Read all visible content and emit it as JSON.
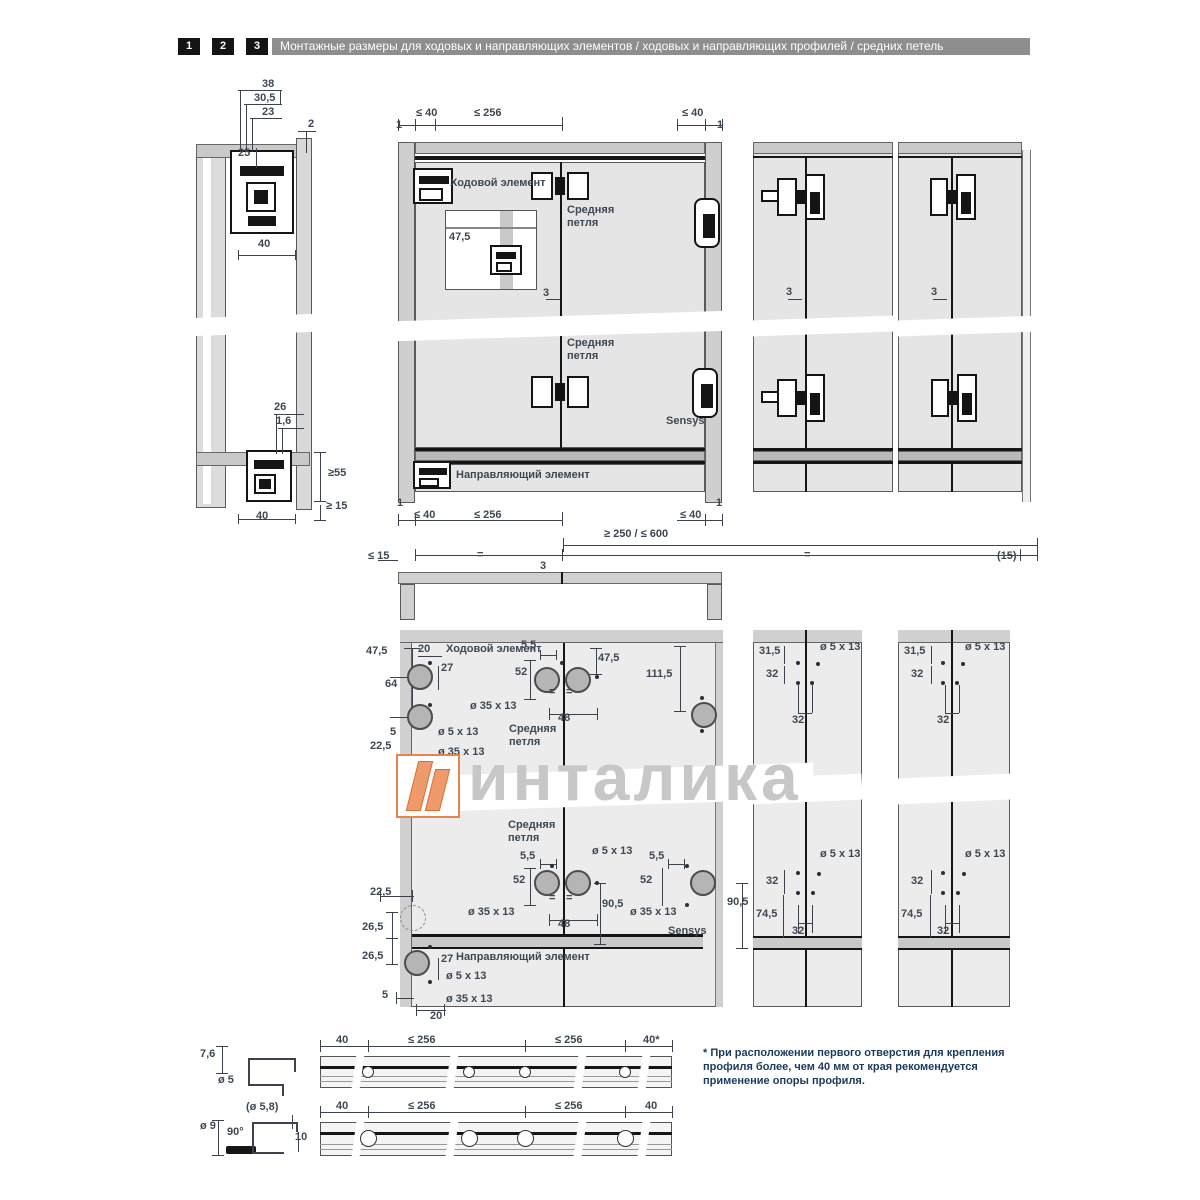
{
  "header": {
    "tabs": [
      "1",
      "2",
      "3"
    ],
    "title": "Монтажные размеры для ходовых и направляющих элементов / ходовых и направляющих профилей / средних петель"
  },
  "watermark": {
    "text": "инталика",
    "logo": "intalika-logo",
    "logo_color": "#E8834F",
    "text_color": "#C7C7C7"
  },
  "footnote": "* При расположении первого отверстия для крепления\nпрофиля более, чем 40 мм от края рекомендуется\nприменение опоры профиля.",
  "colors": {
    "header_bar": "#8E8E8E",
    "tab_bg": "#141414",
    "dim_text": "#3D4854",
    "footnote_text": "#1C3A5E",
    "panel_fill": "#E7E7E7",
    "rail_fill": "#C9C9C9"
  },
  "holes": [
    {
      "x": 420,
      "y": 677,
      "d": 26
    },
    {
      "x": 420,
      "y": 717,
      "d": 26
    },
    {
      "x": 547,
      "y": 680,
      "d": 26
    },
    {
      "x": 578,
      "y": 680,
      "d": 26
    },
    {
      "x": 704,
      "y": 715,
      "d": 26
    },
    {
      "x": 547,
      "y": 883,
      "d": 26
    },
    {
      "x": 578,
      "y": 883,
      "d": 26
    },
    {
      "x": 703,
      "y": 883,
      "d": 26
    },
    {
      "x": 417,
      "y": 963,
      "d": 26
    },
    {
      "x": 413,
      "y": 918,
      "d": 26,
      "dashed": true
    },
    {
      "x": 368,
      "y": 1072,
      "d": 12,
      "rail": true
    },
    {
      "x": 469,
      "y": 1072,
      "d": 12,
      "rail": true
    },
    {
      "x": 525,
      "y": 1072,
      "d": 12,
      "rail": true
    },
    {
      "x": 625,
      "y": 1072,
      "d": 12,
      "rail": true
    },
    {
      "x": 368,
      "y": 1138,
      "d": 17,
      "rail": true
    },
    {
      "x": 469,
      "y": 1138,
      "d": 17,
      "rail": true
    },
    {
      "x": 525,
      "y": 1138,
      "d": 17,
      "rail": true
    },
    {
      "x": 625,
      "y": 1138,
      "d": 17,
      "rail": true
    }
  ],
  "annotations": [
    {
      "name": "dim-38",
      "text": "38",
      "x": 262,
      "y": 78
    },
    {
      "name": "dim-30_5",
      "text": "30,5",
      "x": 254,
      "y": 92
    },
    {
      "name": "dim-23",
      "text": "23",
      "x": 262,
      "y": 106
    },
    {
      "name": "dim-2",
      "text": "2",
      "x": 308,
      "y": 118
    },
    {
      "name": "dim-25",
      "text": "25",
      "x": 238,
      "y": 147
    },
    {
      "name": "dim-40-top",
      "text": "40",
      "x": 258,
      "y": 238
    },
    {
      "name": "dim-26",
      "text": "26",
      "x": 274,
      "y": 401
    },
    {
      "name": "dim-1_6",
      "text": "1,6",
      "x": 276,
      "y": 415
    },
    {
      "name": "dim-ge55",
      "text": "≥55",
      "x": 328,
      "y": 467
    },
    {
      "name": "dim-ge15",
      "text": "≥ 15",
      "x": 326,
      "y": 500
    },
    {
      "name": "dim-40-bottom",
      "text": "40",
      "x": 256,
      "y": 510
    },
    {
      "name": "dim-le40-top-left",
      "text": "≤ 40",
      "x": 416,
      "y": 107
    },
    {
      "name": "dim-le256-top",
      "text": "≤ 256",
      "x": 474,
      "y": 107
    },
    {
      "name": "dim-le40-top-right",
      "text": "≤ 40",
      "x": 682,
      "y": 107
    },
    {
      "name": "dim-1-top-left",
      "text": "1",
      "x": 396,
      "y": 119
    },
    {
      "name": "dim-1-top-right",
      "text": "1",
      "x": 717,
      "y": 119
    },
    {
      "name": "label-running-element",
      "text": "Ходовой элемент",
      "x": 450,
      "y": 177
    },
    {
      "name": "label-middle-hinge-1",
      "text": "Средняя\nпетля",
      "x": 567,
      "y": 204,
      "ml": true
    },
    {
      "name": "dim-47_5-inset",
      "text": "47,5",
      "x": 449,
      "y": 231
    },
    {
      "name": "dim-3-main",
      "text": "3",
      "x": 543,
      "y": 287
    },
    {
      "name": "label-middle-hinge-2",
      "text": "Средняя\nпетля",
      "x": 567,
      "y": 337,
      "ml": true
    },
    {
      "name": "label-sensys-1",
      "text": "Sensys",
      "x": 666,
      "y": 415
    },
    {
      "name": "label-guide-element-1",
      "text": "Направляющий элемент",
      "x": 456,
      "y": 469
    },
    {
      "name": "dim-1-bottom-left",
      "text": "1",
      "x": 397,
      "y": 497
    },
    {
      "name": "dim-le40-bottom-left",
      "text": "≤ 40",
      "x": 414,
      "y": 509
    },
    {
      "name": "dim-le256-bottom",
      "text": "≤ 256",
      "x": 474,
      "y": 509
    },
    {
      "name": "dim-1-bottom-right",
      "text": "1",
      "x": 716,
      "y": 497
    },
    {
      "name": "dim-le40-bottom-right",
      "text": "≤ 40",
      "x": 680,
      "y": 509
    },
    {
      "name": "dim-ge250-le600",
      "text": "≥ 250 / ≤ 600",
      "x": 604,
      "y": 528
    },
    {
      "name": "dim-3-right-1",
      "text": "3",
      "x": 786,
      "y": 286
    },
    {
      "name": "dim-3-right-2",
      "text": "3",
      "x": 931,
      "y": 286
    },
    {
      "name": "dim-le15",
      "text": "≤ 15",
      "x": 368,
      "y": 550
    },
    {
      "name": "eq-mark-left",
      "text": "=",
      "x": 477,
      "y": 549
    },
    {
      "name": "dim-3-plan",
      "text": "3",
      "x": 540,
      "y": 560
    },
    {
      "name": "eq-mark-right",
      "text": "=",
      "x": 804,
      "y": 549
    },
    {
      "name": "dim-15-paren",
      "text": "(15)",
      "x": 997,
      "y": 550
    },
    {
      "name": "dim-47_5-drill-left",
      "text": "47,5",
      "x": 366,
      "y": 645
    },
    {
      "name": "dim-20-top",
      "text": "20",
      "x": 418,
      "y": 643
    },
    {
      "name": "label-running-element-2",
      "text": "Ходовой элемент",
      "x": 446,
      "y": 643
    },
    {
      "name": "dim-5_5-top",
      "text": "5,5",
      "x": 521,
      "y": 639
    },
    {
      "name": "dim-27-top",
      "text": "27",
      "x": 441,
      "y": 662
    },
    {
      "name": "dim-52-top",
      "text": "52",
      "x": 515,
      "y": 666
    },
    {
      "name": "dim-64",
      "text": "64",
      "x": 385,
      "y": 678
    },
    {
      "name": "dim-47_5-drill-right",
      "text": "47,5",
      "x": 598,
      "y": 652
    },
    {
      "name": "dim-111_5",
      "text": "111,5",
      "x": 646,
      "y": 668
    },
    {
      "name": "dia-35x13-top",
      "text": "ø 35 x 13",
      "x": 470,
      "y": 700
    },
    {
      "name": "eq-top-1",
      "text": "=",
      "x": 549,
      "y": 686
    },
    {
      "name": "eq-top-2",
      "text": "=",
      "x": 566,
      "y": 686
    },
    {
      "name": "dim-48-top",
      "text": "48",
      "x": 558,
      "y": 712
    },
    {
      "name": "dim-5-left",
      "text": "5",
      "x": 390,
      "y": 726
    },
    {
      "name": "dia-5x13-left",
      "text": "ø 5 x 13",
      "x": 438,
      "y": 726
    },
    {
      "name": "dim-22_5-upper",
      "text": "22,5",
      "x": 370,
      "y": 740
    },
    {
      "name": "dia-35x13-left",
      "text": "ø 35 x 13",
      "x": 438,
      "y": 746
    },
    {
      "name": "label-middle-hinge-3",
      "text": "Средняя\nпетля",
      "x": 509,
      "y": 723,
      "ml": true
    },
    {
      "name": "dim-31_5-col1",
      "text": "31,5",
      "x": 759,
      "y": 645
    },
    {
      "name": "dia-5x13-col1-top",
      "text": "ø 5 x 13",
      "x": 820,
      "y": 641
    },
    {
      "name": "dim-32v-col1-top",
      "text": "32",
      "x": 766,
      "y": 668
    },
    {
      "name": "dim-32h-col1-top",
      "text": "32",
      "x": 792,
      "y": 714
    },
    {
      "name": "dim-31_5-col2",
      "text": "31,5",
      "x": 904,
      "y": 645
    },
    {
      "name": "dia-5x13-col2-top",
      "text": "ø 5 x 13",
      "x": 965,
      "y": 641
    },
    {
      "name": "dim-32v-col2-top",
      "text": "32",
      "x": 911,
      "y": 668
    },
    {
      "name": "dim-32h-col2-top",
      "text": "32",
      "x": 937,
      "y": 714
    },
    {
      "name": "label-middle-hinge-4",
      "text": "Средняя\nпетля",
      "x": 508,
      "y": 819,
      "ml": true
    },
    {
      "name": "dia-5x13-mid",
      "text": "ø 5 x 13",
      "x": 592,
      "y": 845
    },
    {
      "name": "dim-5_5-mid-left",
      "text": "5,5",
      "x": 520,
      "y": 850
    },
    {
      "name": "dim-52-mid-left",
      "text": "52",
      "x": 513,
      "y": 874
    },
    {
      "name": "dia-35x13-mid-left",
      "text": "ø 35 x 13",
      "x": 468,
      "y": 906
    },
    {
      "name": "dim-48-mid",
      "text": "48",
      "x": 558,
      "y": 918
    },
    {
      "name": "dim-90_5-mid",
      "text": "90,5",
      "x": 602,
      "y": 898
    },
    {
      "name": "eq-mid-1",
      "text": "=",
      "x": 549,
      "y": 892
    },
    {
      "name": "eq-mid-2",
      "text": "=",
      "x": 566,
      "y": 892
    },
    {
      "name": "dim-5_5-mid-right",
      "text": "5,5",
      "x": 649,
      "y": 850
    },
    {
      "name": "dim-52-mid-right",
      "text": "52",
      "x": 640,
      "y": 874
    },
    {
      "name": "dia-35x13-mid-right",
      "text": "ø 35 x 13",
      "x": 630,
      "y": 906
    },
    {
      "name": "label-sensys-2",
      "text": "Sensys",
      "x": 668,
      "y": 925
    },
    {
      "name": "dim-90_5-right",
      "text": "90,5",
      "x": 727,
      "y": 896
    },
    {
      "name": "dim-32v-col1-bot",
      "text": "32",
      "x": 766,
      "y": 875
    },
    {
      "name": "dia-5x13-col1-bot",
      "text": "ø 5 x 13",
      "x": 820,
      "y": 848
    },
    {
      "name": "dim-74_5-col1",
      "text": "74,5",
      "x": 756,
      "y": 908
    },
    {
      "name": "dim-32h-col1-bot",
      "text": "32",
      "x": 792,
      "y": 925
    },
    {
      "name": "dim-32v-col2-bot",
      "text": "32",
      "x": 911,
      "y": 875
    },
    {
      "name": "dia-5x13-col2-bot",
      "text": "ø 5 x 13",
      "x": 965,
      "y": 848
    },
    {
      "name": "dim-74_5-col2",
      "text": "74,5",
      "x": 901,
      "y": 908
    },
    {
      "name": "dim-32h-col2-bot",
      "text": "32",
      "x": 937,
      "y": 925
    },
    {
      "name": "dim-22_5-lower",
      "text": "22,5",
      "x": 370,
      "y": 886
    },
    {
      "name": "dim-26_5-a",
      "text": "26,5",
      "x": 362,
      "y": 921
    },
    {
      "name": "dim-26_5-b",
      "text": "26,5",
      "x": 362,
      "y": 950
    },
    {
      "name": "dim-27-bottom",
      "text": "27",
      "x": 441,
      "y": 953
    },
    {
      "name": "label-guide-element-2",
      "text": "Направляющий элемент",
      "x": 456,
      "y": 951
    },
    {
      "name": "dia-5x13-bottom",
      "text": "ø 5 x 13",
      "x": 446,
      "y": 970
    },
    {
      "name": "dim-5-bottom",
      "text": "5",
      "x": 382,
      "y": 989
    },
    {
      "name": "dia-35x13-bottom",
      "text": "ø 35 x 13",
      "x": 446,
      "y": 993
    },
    {
      "name": "dim-20-bottom",
      "text": "20",
      "x": 430,
      "y": 1010
    },
    {
      "name": "dim-7_6",
      "text": "7,6",
      "x": 200,
      "y": 1048
    },
    {
      "name": "dia-5-rail",
      "text": "ø 5",
      "x": 218,
      "y": 1074
    },
    {
      "name": "dim-40-rail1-left",
      "text": "40",
      "x": 336,
      "y": 1034
    },
    {
      "name": "dim-le256-rail1-a",
      "text": "≤ 256",
      "x": 408,
      "y": 1034
    },
    {
      "name": "dim-le256-rail1-b",
      "text": "≤ 256",
      "x": 555,
      "y": 1034
    },
    {
      "name": "dim-40-rail1-right",
      "text": "40*",
      "x": 643,
      "y": 1034
    },
    {
      "name": "dia-5_8-paren",
      "text": "(ø 5,8)",
      "x": 246,
      "y": 1101
    },
    {
      "name": "dia-9",
      "text": "ø 9",
      "x": 200,
      "y": 1120
    },
    {
      "name": "angle-90",
      "text": "90°",
      "x": 227,
      "y": 1126
    },
    {
      "name": "dim-10",
      "text": "10",
      "x": 295,
      "y": 1131
    },
    {
      "name": "dim-40-rail2-left",
      "text": "40",
      "x": 336,
      "y": 1100
    },
    {
      "name": "dim-le256-rail2-a",
      "text": "≤ 256",
      "x": 408,
      "y": 1100
    },
    {
      "name": "dim-le256-rail2-b",
      "text": "≤ 256",
      "x": 555,
      "y": 1100
    },
    {
      "name": "dim-40-rail2-right",
      "text": "40",
      "x": 645,
      "y": 1100
    }
  ]
}
